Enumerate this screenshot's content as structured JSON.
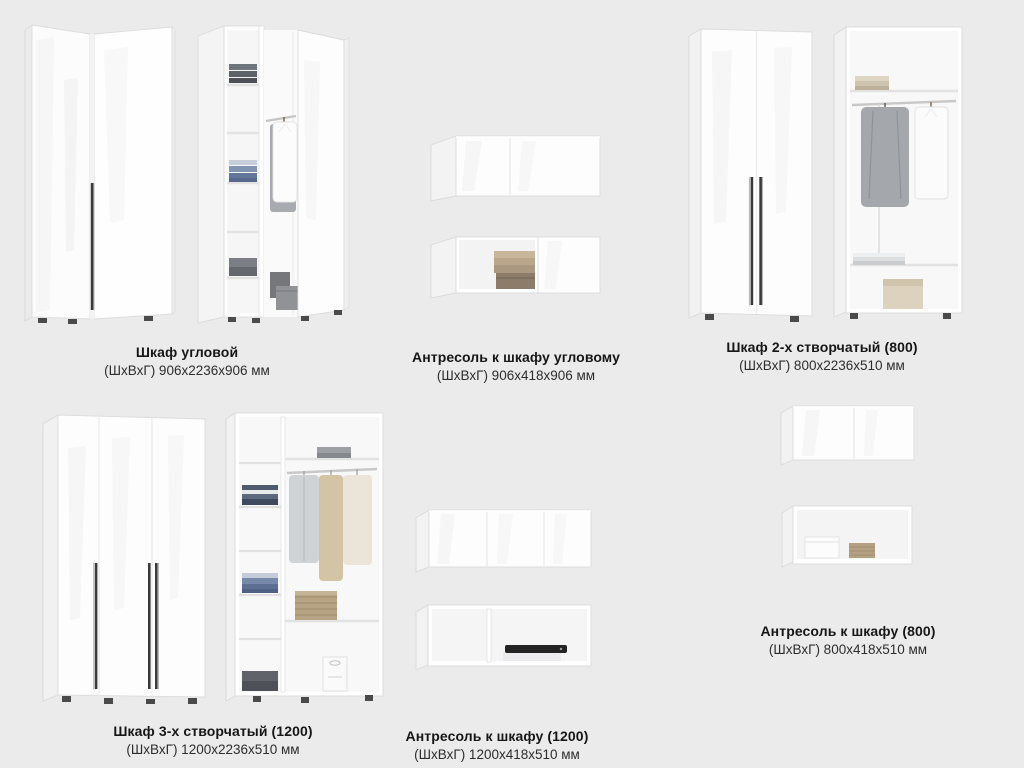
{
  "page": {
    "background_color": "#ebebeb",
    "text_color": "#161616",
    "accent_handle_color": "#3a3a3a"
  },
  "products": [
    {
      "title": "Шкаф угловой",
      "dims": "(ШхВхГ) 906x2236x906 мм"
    },
    {
      "title": "Антресоль к шкафу угловому",
      "dims": "(ШхВхГ) 906x418x906 мм"
    },
    {
      "title": "Шкаф 2-х створчатый (800)",
      "dims": "(ШхВхГ) 800x2236x510 мм"
    },
    {
      "title": "Шкаф 3-х створчатый (1200)",
      "dims": "(ШхВхГ) 1200x2236x510 мм"
    },
    {
      "title": "Антресоль к шкафу (1200)",
      "dims": "(ШхВхГ) 1200x418x510 мм"
    },
    {
      "title": "Антресоль к шкафу (800)",
      "dims": "(ШхВхГ) 800x418x510 мм"
    }
  ]
}
